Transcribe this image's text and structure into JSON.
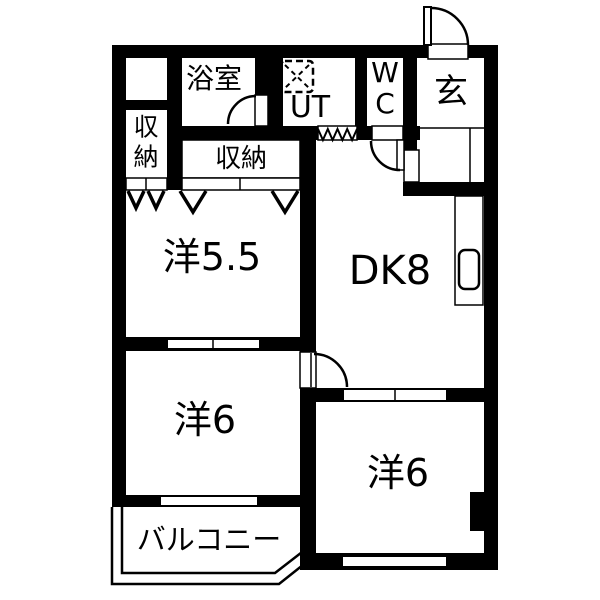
{
  "floorplan": {
    "type": "apartment-floor-plan",
    "colors": {
      "wall": "#000000",
      "floor": "#ffffff",
      "line": "#000000"
    },
    "rooms": [
      {
        "id": "bathroom",
        "label": "浴室"
      },
      {
        "id": "utility",
        "label": "UT"
      },
      {
        "id": "toilet",
        "label": "WC",
        "lines": [
          "W",
          "C"
        ]
      },
      {
        "id": "entrance",
        "label": "玄"
      },
      {
        "id": "closet-left",
        "label": "収納",
        "lines": [
          "収",
          "納"
        ]
      },
      {
        "id": "closet-top",
        "label": "収納"
      },
      {
        "id": "western-room-5-5",
        "label": "洋5.5"
      },
      {
        "id": "dining-kitchen",
        "label": "DK8"
      },
      {
        "id": "western-room-6-left",
        "label": "洋6"
      },
      {
        "id": "western-room-6-right",
        "label": "洋6"
      },
      {
        "id": "balcony",
        "label": "バルコニー"
      }
    ],
    "symbols": [
      {
        "name": "washing-machine-pan-icon"
      },
      {
        "name": "door-swing-arc"
      },
      {
        "name": "folding-door-triangles"
      },
      {
        "name": "accordion-door-zigzag"
      },
      {
        "name": "kitchen-sink"
      }
    ]
  }
}
